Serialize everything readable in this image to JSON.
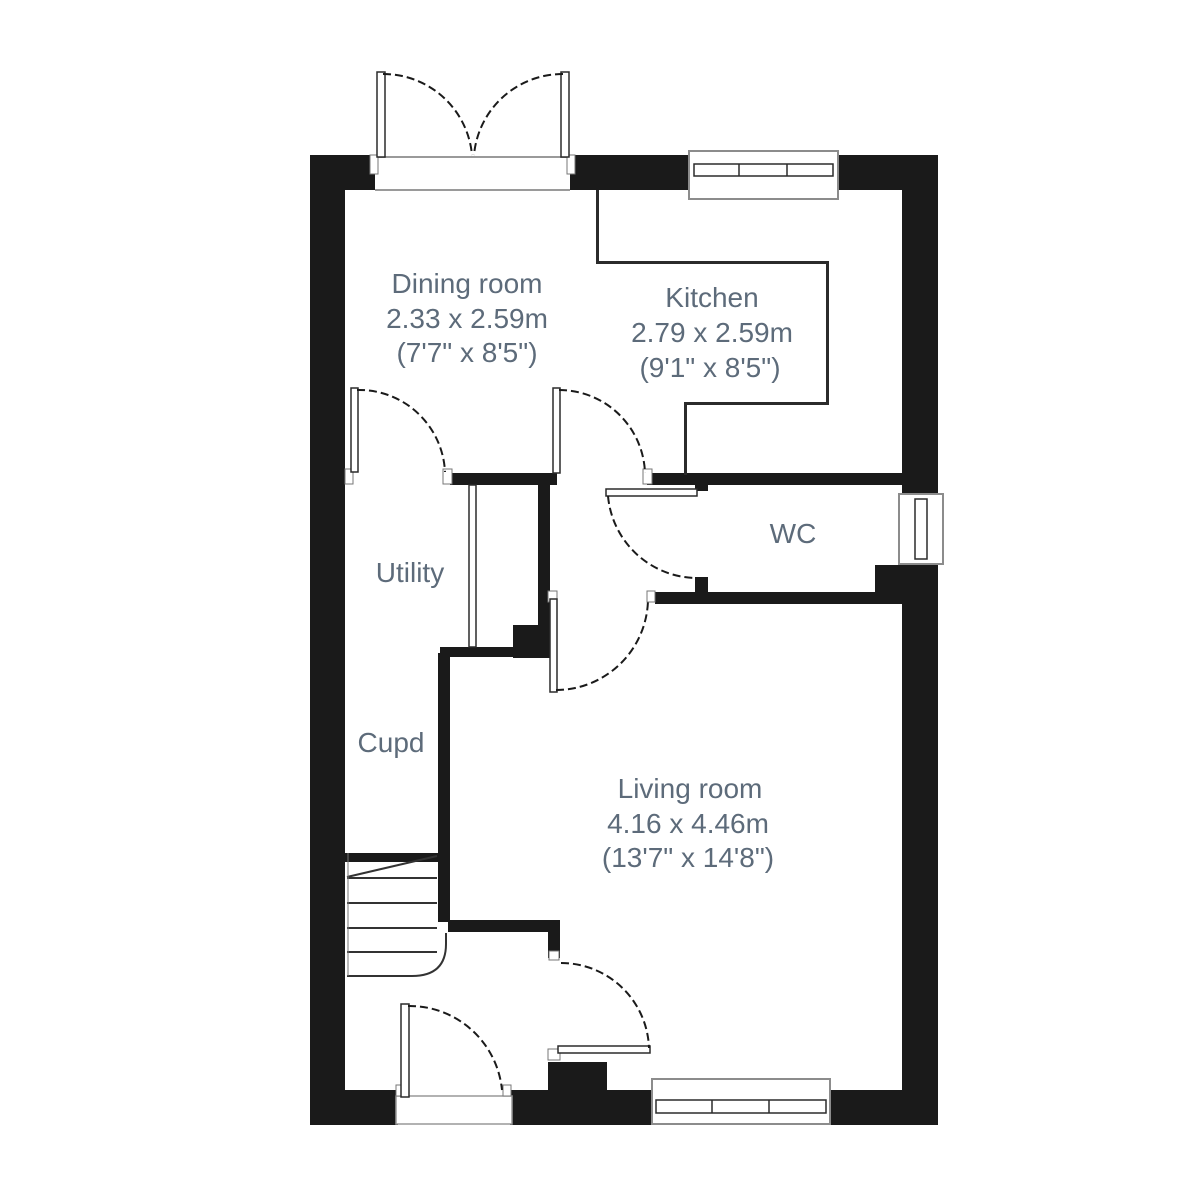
{
  "plan": {
    "title": "Ground floor plan",
    "colors": {
      "wall": "#1a1a1a",
      "thin_wall": "#242424",
      "label_text": "#5d6b7a",
      "background": "#ffffff",
      "window_outline": "#8c8c8c"
    },
    "rooms": [
      {
        "id": "dining",
        "label": "Dining room",
        "size_metric": "2.33 x 2.59m",
        "size_imperial": "(7'7\" x 8'5\")"
      },
      {
        "id": "kitchen",
        "label": "Kitchen",
        "size_metric": "2.79 x 2.59m",
        "size_imperial": "(9'1\" x 8'5\")"
      },
      {
        "id": "wc",
        "label": "WC"
      },
      {
        "id": "utility",
        "label": "Utility"
      },
      {
        "id": "cupd",
        "label": "Cupd"
      },
      {
        "id": "living",
        "label": "Living room",
        "size_metric": "4.16 x 4.46m",
        "size_imperial": "(13'7\" x 14'8\")"
      }
    ],
    "features": [
      "french-doors-top",
      "kitchen-window-top",
      "wc-window-right",
      "living-window-bottom",
      "front-door-bottom",
      "staircase",
      "under-stair-cupboard"
    ]
  }
}
